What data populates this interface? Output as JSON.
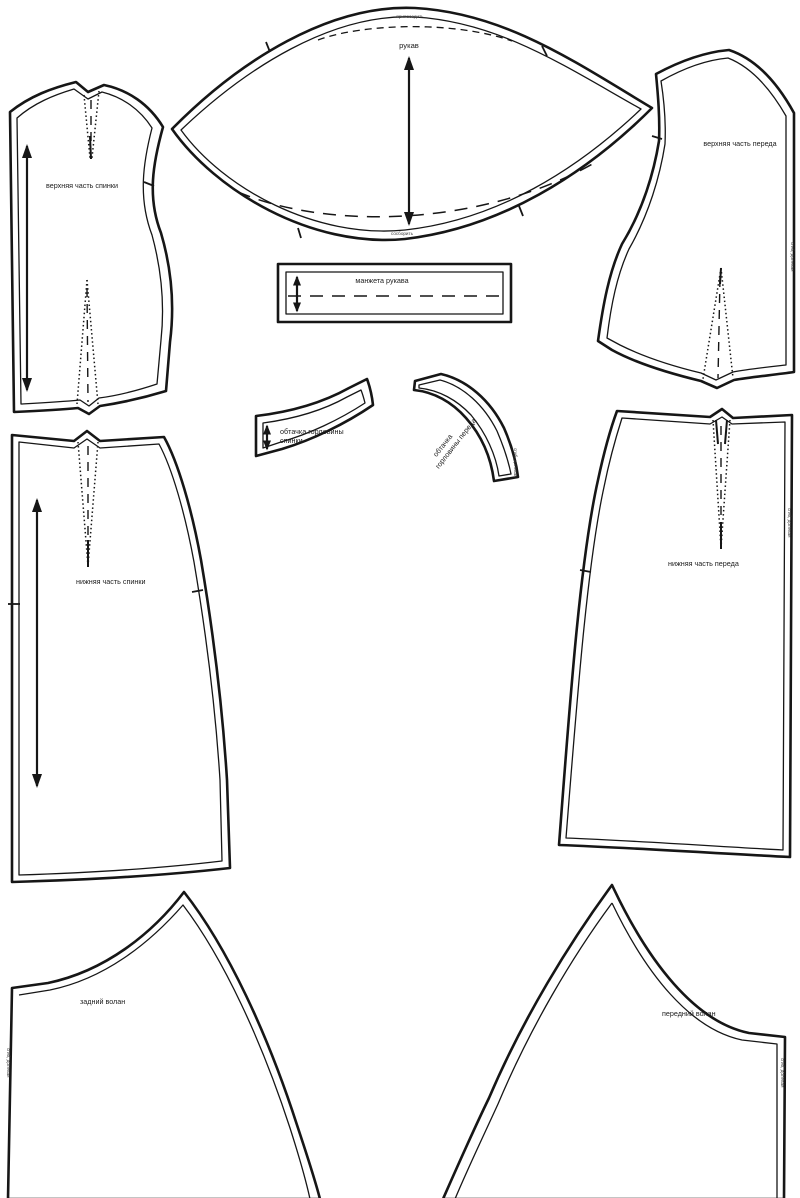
{
  "sheet": {
    "background": "#ffffff",
    "ink": "#161616",
    "type": "sewing-pattern-sheet"
  },
  "pieces": {
    "upper_back": {
      "label": "верхняя часть спинки"
    },
    "sleeve": {
      "label": "рукав",
      "ease_note": "припосадить",
      "gather_note": "сосборить"
    },
    "upper_front": {
      "label": "верхняя часть переда",
      "fold_note": "сгиб, долевая"
    },
    "cuff": {
      "label": "манжета рукава"
    },
    "back_neck_facing": {
      "label_line1": "обтачка горловины",
      "label_line2": "спинки"
    },
    "front_neck_facing": {
      "label_line1": "обтачка",
      "label_line2": "горловины переда",
      "fold_note": "сгиб, долевая"
    },
    "lower_back": {
      "label": "нижняя часть спинки"
    },
    "lower_front": {
      "label": "нижняя часть переда",
      "fold_note": "сгиб, долевая"
    },
    "back_flounce": {
      "label": "задний волан",
      "fold_note": "сгиб, долевая"
    },
    "front_flounce": {
      "label": "передний волан",
      "fold_note": "сгиб, долевая"
    }
  }
}
